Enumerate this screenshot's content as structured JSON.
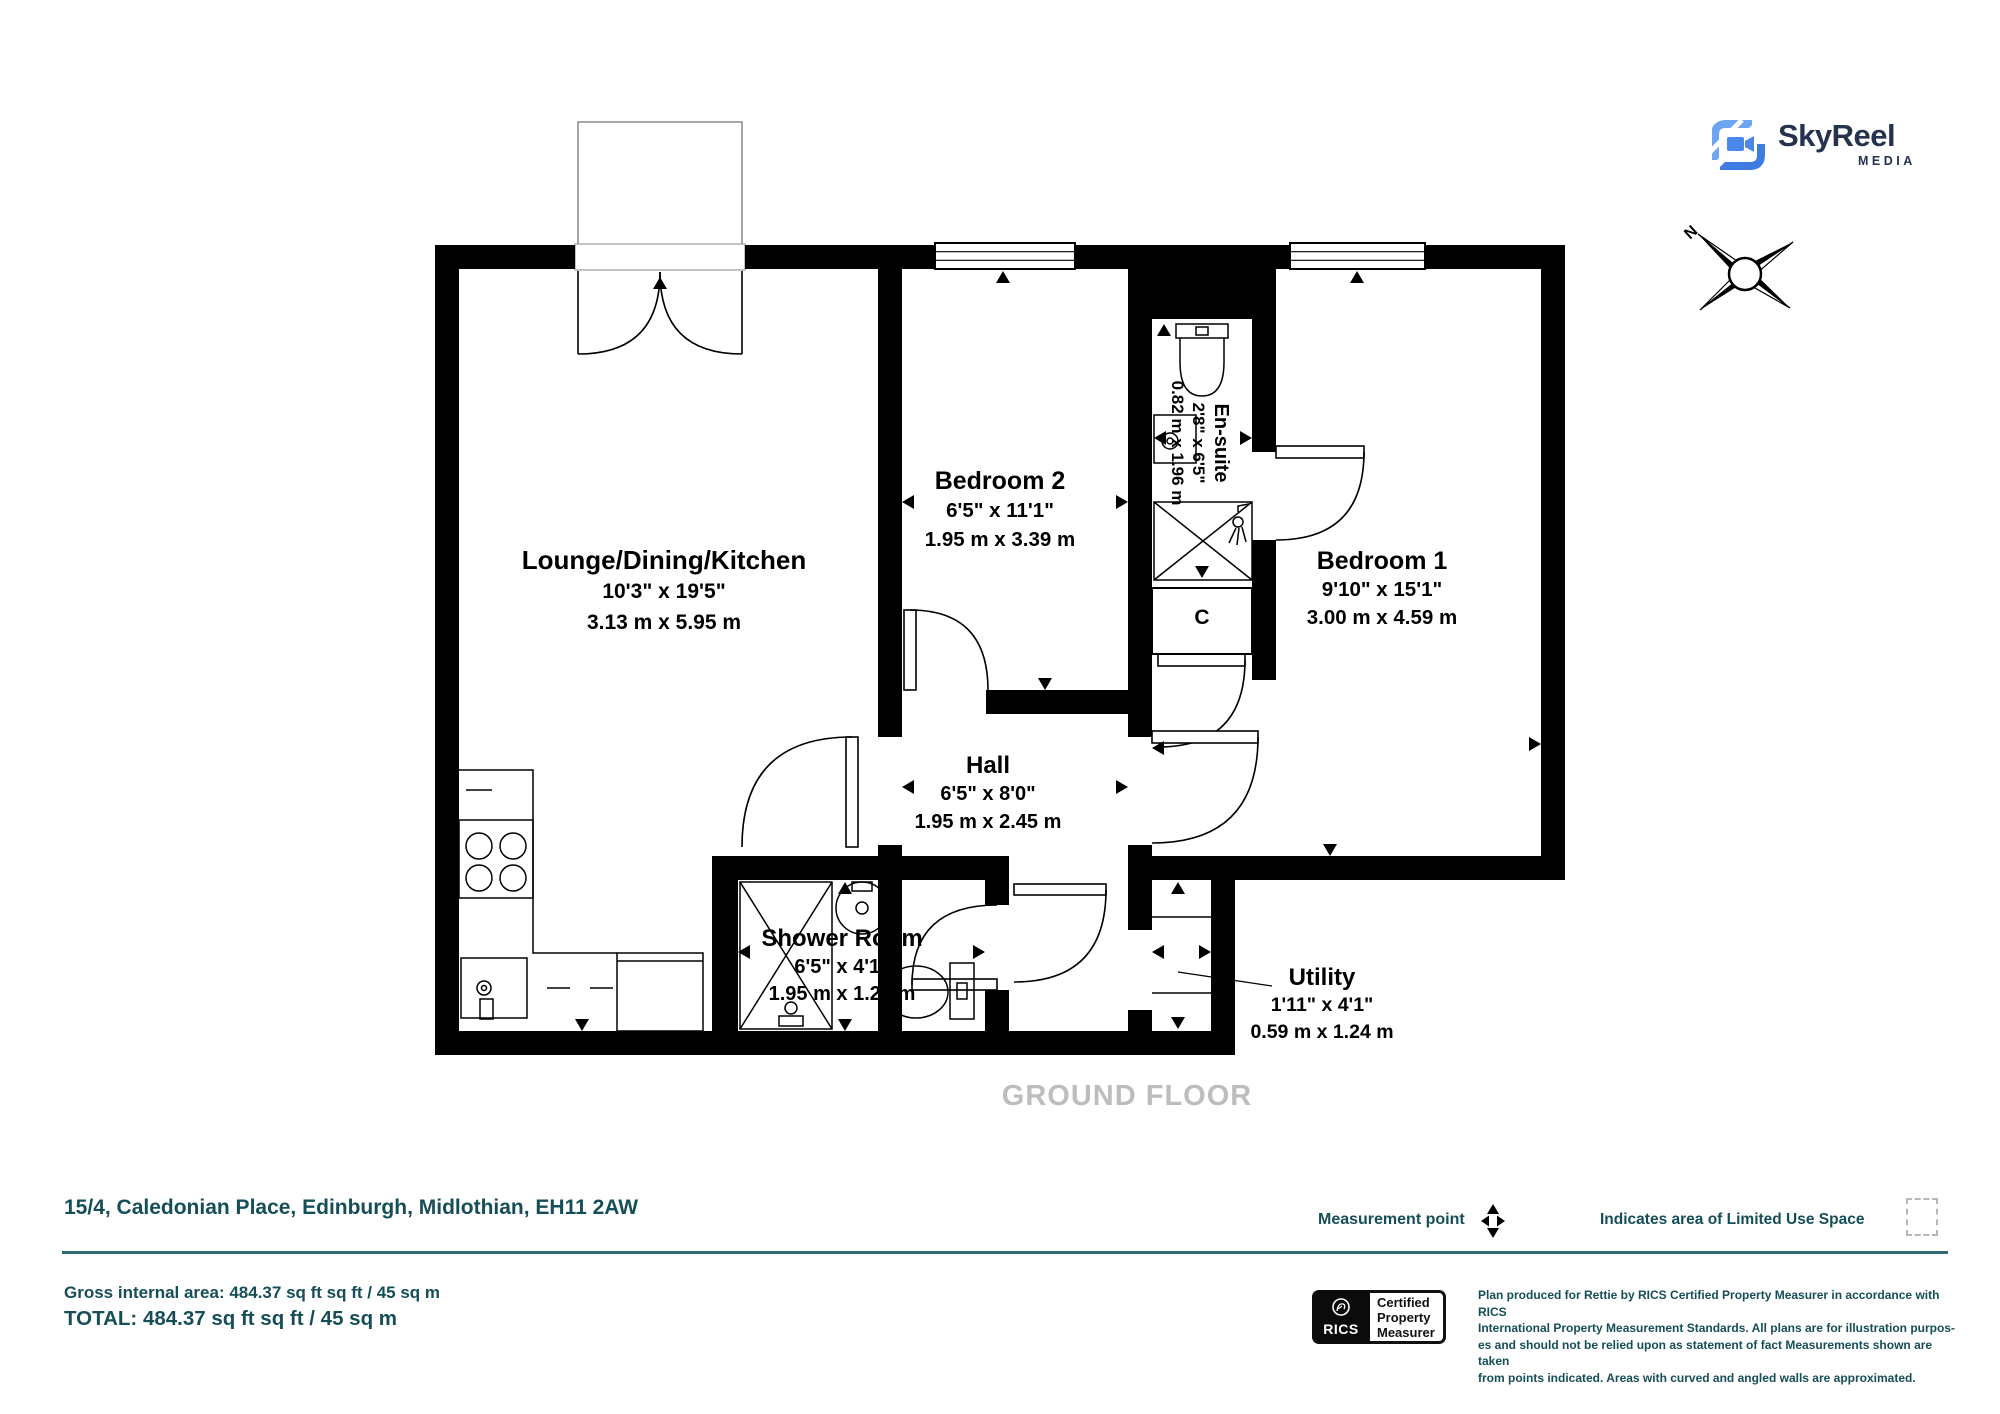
{
  "branding": {
    "name": "SkyReel",
    "sub": "MEDIA",
    "navy": "#25334f",
    "blue": "#4a87e8"
  },
  "compass": {
    "north_label": "N"
  },
  "floorplan": {
    "floor_label": "GROUND FLOOR",
    "cupboard_label": "C",
    "rooms": [
      {
        "name": "Lounge/Dining/Kitchen",
        "imperial": "10'3\" x 19'5\"",
        "metric": "3.13 m x 5.95 m"
      },
      {
        "name": "Bedroom 2",
        "imperial": "6'5\" x 11'1\"",
        "metric": "1.95 m x 3.39 m"
      },
      {
        "name": "En-suite",
        "imperial": "2'8\" x 6'5\"",
        "metric": "0.82 m x 1.96 m"
      },
      {
        "name": "Bedroom 1",
        "imperial": "9'10\" x 15'1\"",
        "metric": "3.00 m x 4.59 m"
      },
      {
        "name": "Hall",
        "imperial": "6'5\" x 8'0\"",
        "metric": "1.95 m x 2.45 m"
      },
      {
        "name": "Shower Room",
        "imperial": "6'5\" x 4'1\"",
        "metric": "1.95 m x 1.24 m"
      },
      {
        "name": "Utility",
        "imperial": "1'11\" x 4'1\"",
        "metric": "0.59 m x 1.24 m"
      }
    ]
  },
  "footer": {
    "address": "15/4, Caledonian Place, Edinburgh, Midlothian, EH11 2AW",
    "gross_area": "Gross internal area: 484.37 sq ft sq ft / 45 sq m",
    "total": "TOTAL: 484.37 sq ft sq ft / 45 sq m",
    "measurement_point_label": "Measurement point",
    "limited_use_label": "Indicates area of  Limited Use Space",
    "rics": {
      "org": "RICS",
      "lines": [
        "Certified",
        "Property",
        "Measurer"
      ]
    },
    "disclaimer_lines": [
      "Plan produced for Rettie by RICS Certified Property Measurer in accordance with RICS",
      "International Property  Measurement Standards.  All plans are for illustration purpos-",
      "es and should not be relied upon as statement of fact Measurements shown are taken",
      "from points indicated. Areas with curved and angled walls are approximated."
    ]
  },
  "colors": {
    "teal": "#164e58",
    "rule": "#2e6b74",
    "floor_gray": "#bdbdbd",
    "wall": "#000000"
  }
}
